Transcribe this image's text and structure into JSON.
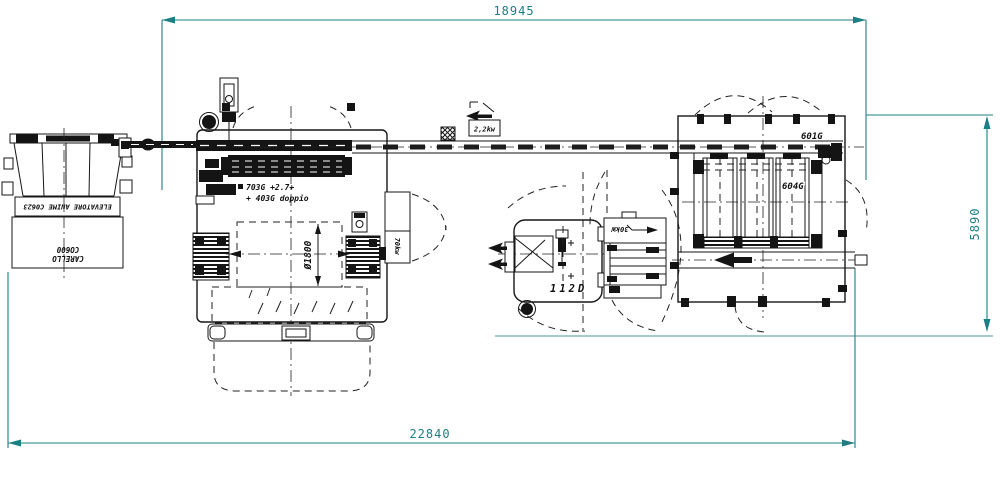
{
  "dims": {
    "top": "18945",
    "bottom": "22840",
    "right": "5890"
  },
  "labels": {
    "elevator": "ELEVATORE ANIME C0623",
    "carello1": "CARELLO",
    "carello2": "CO600",
    "m703a": "703G +2.7+",
    "m703b": "+ 403G doppio",
    "dia": "Ø1800",
    "p70": "70kw",
    "p22": "2,2kw",
    "m112": "112D",
    "p30": "30kW",
    "m601": "601G",
    "m604": "604G"
  },
  "colors": {
    "line": "#161616",
    "dimension": "#1b7f84",
    "background": "#ffffff"
  }
}
